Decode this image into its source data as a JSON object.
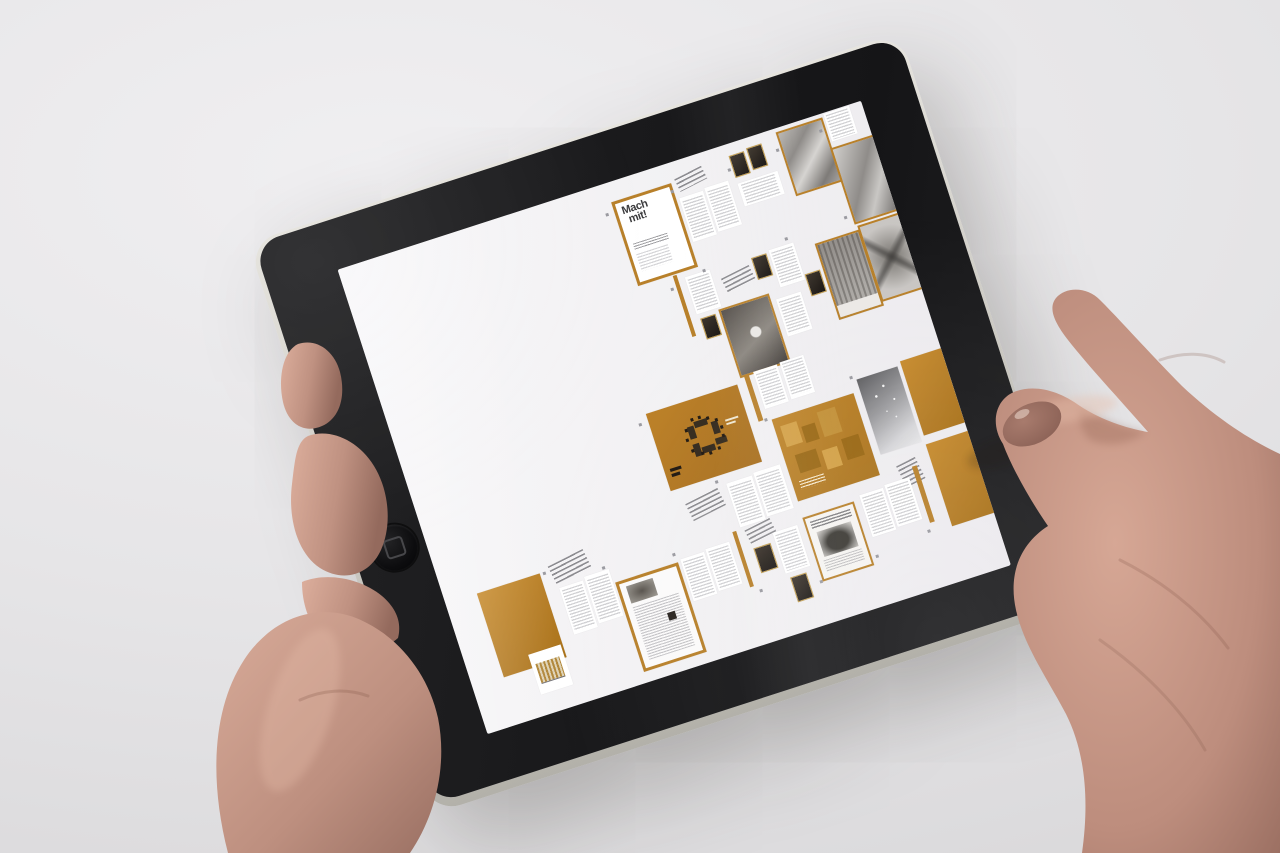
{
  "background_color": "#e6e5e7",
  "device": {
    "bezel_color": "#1a1a1c",
    "edge_color": "#cfcdc6",
    "home_button_icon": "home-button-icon"
  },
  "screen": {
    "background": "#f2f1f3",
    "accent_orange": "#b8802a",
    "cover_title_line1": "Mach",
    "cover_title_line2": "mit!",
    "pages": [
      {
        "t": "cover",
        "x": 51,
        "y": 4,
        "w": 10.5,
        "h": 17
      },
      {
        "t": "head",
        "x": 63.5,
        "y": 3,
        "w": 5.5,
        "h": 2.8
      },
      {
        "t": "txt",
        "x": 63,
        "y": 7.6,
        "w": 4.6,
        "h": 9.5
      },
      {
        "t": "txt",
        "x": 68,
        "y": 7.2,
        "w": 4.6,
        "h": 9.5
      },
      {
        "t": "dark",
        "x": 74,
        "y": 2.4,
        "w": 2.6,
        "h": 4.4
      },
      {
        "t": "dark",
        "x": 77.4,
        "y": 2,
        "w": 2.6,
        "h": 4.4
      },
      {
        "t": "txt",
        "x": 74,
        "y": 8.4,
        "w": 7.6,
        "h": 5
      },
      {
        "t": "photo",
        "x": 83.5,
        "y": 0.8,
        "w": 8.2,
        "h": 13
      },
      {
        "t": "txt",
        "x": 92.8,
        "y": 0.2,
        "w": 4.8,
        "h": 6
      },
      {
        "t": "photo2",
        "x": 92,
        "y": 7.4,
        "w": 8.4,
        "h": 15.6
      },
      {
        "t": "vline",
        "x": 57.6,
        "y": 22.4,
        "w": 0.8,
        "h": 13
      },
      {
        "t": "txt",
        "x": 59.6,
        "y": 23.4,
        "w": 4.8,
        "h": 8
      },
      {
        "t": "dark",
        "x": 60,
        "y": 32.4,
        "w": 2.5,
        "h": 4
      },
      {
        "t": "head",
        "x": 66,
        "y": 25.4,
        "w": 5.6,
        "h": 3
      },
      {
        "t": "dark",
        "x": 72.2,
        "y": 23.8,
        "w": 2.5,
        "h": 4.2
      },
      {
        "t": "txt",
        "x": 75.6,
        "y": 23.4,
        "w": 4.8,
        "h": 8
      },
      {
        "t": "photo3",
        "x": 63.6,
        "y": 31.8,
        "w": 9,
        "h": 14
      },
      {
        "t": "txt",
        "x": 74.2,
        "y": 33.4,
        "w": 4.8,
        "h": 8
      },
      {
        "t": "dark",
        "x": 80.6,
        "y": 30.4,
        "w": 2.5,
        "h": 4.2
      },
      {
        "t": "phototex",
        "x": 84,
        "y": 25,
        "w": 7.8,
        "h": 15.6
      },
      {
        "t": "photox",
        "x": 92.4,
        "y": 24.2,
        "w": 7.8,
        "h": 15.6
      },
      {
        "t": "people",
        "x": 45.2,
        "y": 47.6,
        "w": 17.6,
        "h": 16.6
      },
      {
        "t": "vline",
        "x": 64.4,
        "y": 46.2,
        "w": 0.8,
        "h": 10
      },
      {
        "t": "txt",
        "x": 66.2,
        "y": 46.2,
        "w": 4.6,
        "h": 8
      },
      {
        "t": "txt",
        "x": 71.2,
        "y": 45.8,
        "w": 4.6,
        "h": 8
      },
      {
        "t": "head",
        "x": 47.2,
        "y": 67,
        "w": 6.6,
        "h": 3.8
      },
      {
        "t": "txt",
        "x": 55.2,
        "y": 66.2,
        "w": 5,
        "h": 9.5
      },
      {
        "t": "txt",
        "x": 60.6,
        "y": 65.8,
        "w": 5,
        "h": 9.5
      },
      {
        "t": "ocollage",
        "x": 66.8,
        "y": 56.6,
        "w": 15.6,
        "h": 17.6
      },
      {
        "t": "grad",
        "x": 83.6,
        "y": 54.2,
        "w": 7.8,
        "h": 16
      },
      {
        "t": "orange",
        "x": 92.2,
        "y": 53.2,
        "w": 7.8,
        "h": 16
      },
      {
        "t": "head",
        "x": 86,
        "y": 73.2,
        "w": 3.8,
        "h": 5.4
      },
      {
        "t": "orange",
        "x": 92,
        "y": 71.2,
        "w": 8.4,
        "h": 17.6
      },
      {
        "t": "orange",
        "x": 6,
        "y": 72,
        "w": 12,
        "h": 18
      },
      {
        "t": "head",
        "x": 20,
        "y": 70.5,
        "w": 7,
        "h": 4
      },
      {
        "t": "txt",
        "x": 20.5,
        "y": 76,
        "w": 4.6,
        "h": 10
      },
      {
        "t": "txt",
        "x": 25.5,
        "y": 75.5,
        "w": 4.6,
        "h": 10
      },
      {
        "t": "chart",
        "x": 11.5,
        "y": 87,
        "w": 6.2,
        "h": 8.6
      },
      {
        "t": "article",
        "x": 30.5,
        "y": 78.5,
        "w": 11,
        "h": 18
      },
      {
        "t": "txt",
        "x": 43,
        "y": 78,
        "w": 4.6,
        "h": 9
      },
      {
        "t": "txt",
        "x": 48,
        "y": 77.6,
        "w": 4.6,
        "h": 9
      },
      {
        "t": "vline",
        "x": 53.6,
        "y": 76,
        "w": 0.8,
        "h": 12
      },
      {
        "t": "head",
        "x": 56,
        "y": 76,
        "w": 5,
        "h": 3
      },
      {
        "t": "dark",
        "x": 56.4,
        "y": 80.6,
        "w": 2.9,
        "h": 4.8
      },
      {
        "t": "txt",
        "x": 60.6,
        "y": 78.6,
        "w": 4.6,
        "h": 9
      },
      {
        "t": "dark",
        "x": 61,
        "y": 88.6,
        "w": 2.9,
        "h": 4.8
      },
      {
        "t": "ad",
        "x": 66.6,
        "y": 77.6,
        "w": 9,
        "h": 13
      },
      {
        "t": "txt",
        "x": 77.6,
        "y": 76.8,
        "w": 4.6,
        "h": 9
      },
      {
        "t": "txt",
        "x": 82.6,
        "y": 76.4,
        "w": 4.6,
        "h": 9
      },
      {
        "t": "vline",
        "x": 88.4,
        "y": 74.6,
        "w": 0.8,
        "h": 12
      }
    ],
    "dots": [
      {
        "x": 49.5,
        "y": 6
      },
      {
        "x": 62,
        "y": 5.5
      },
      {
        "x": 73,
        "y": 5
      },
      {
        "x": 82.5,
        "y": 4
      },
      {
        "x": 91,
        "y": 3
      },
      {
        "x": 56.5,
        "y": 24.5
      },
      {
        "x": 63,
        "y": 23
      },
      {
        "x": 79,
        "y": 22
      },
      {
        "x": 90.5,
        "y": 21.5
      },
      {
        "x": 43.5,
        "y": 49
      },
      {
        "x": 53.5,
        "y": 65
      },
      {
        "x": 65.5,
        "y": 56
      },
      {
        "x": 82.5,
        "y": 53
      },
      {
        "x": 18.5,
        "y": 72
      },
      {
        "x": 29,
        "y": 74.5
      },
      {
        "x": 42,
        "y": 76.5
      },
      {
        "x": 55,
        "y": 89
      },
      {
        "x": 66,
        "y": 91
      },
      {
        "x": 77,
        "y": 89.5
      },
      {
        "x": 87.5,
        "y": 88
      }
    ]
  },
  "hands": {
    "skin_base": "#c79a8a",
    "skin_shadow": "#a3786a",
    "skin_highlight": "#e2b8a6",
    "nail_color": "#8f675c"
  }
}
